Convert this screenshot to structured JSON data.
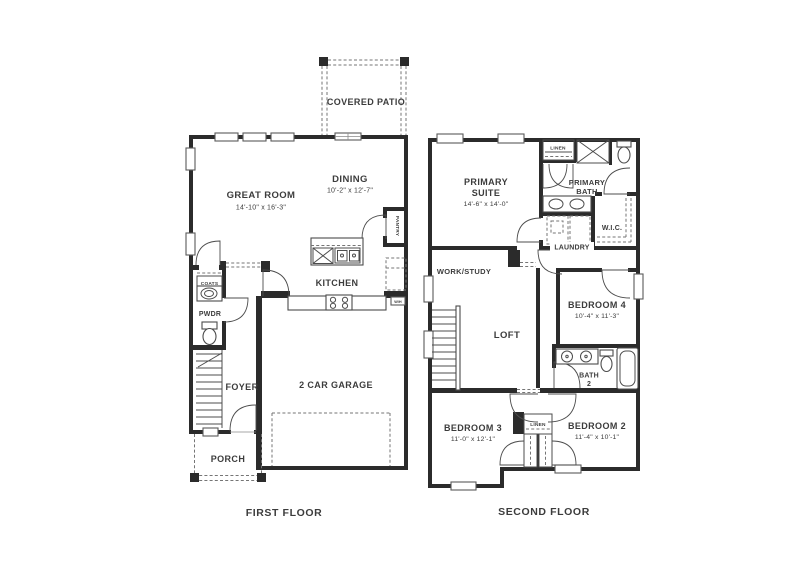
{
  "floors": {
    "first": {
      "title": "FIRST FLOOR",
      "covered_patio": "COVERED PATIO",
      "great_room": {
        "label": "GREAT ROOM",
        "dims": "14'-10\" x 16'-3\""
      },
      "dining": {
        "label": "DINING",
        "dims": "10'-2\" x 12'-7\""
      },
      "kitchen": "KITCHEN",
      "pantry": "PANTRY",
      "coats": "COATS",
      "powder": "PWDR",
      "foyer": "FOYER",
      "garage": "2 CAR GARAGE",
      "porch": "PORCH",
      "water_heater": "W/H"
    },
    "second": {
      "title": "SECOND FLOOR",
      "primary_suite": {
        "line1": "PRIMARY",
        "line2": "SUITE",
        "dims": "14'-6\" x 14'-0\""
      },
      "linen_upper": "LINEN",
      "primary_bath": {
        "line1": "PRIMARY",
        "line2": "BATH"
      },
      "wic": "W.I.C.",
      "laundry": "LAUNDRY",
      "work_study": "WORK/STUDY",
      "loft": "LOFT",
      "bedroom4": {
        "label": "BEDROOM 4",
        "dims": "10'-4\" x 11'-3\""
      },
      "bath2": {
        "line1": "BATH",
        "line2": "2"
      },
      "bedroom3": {
        "label": "BEDROOM 3",
        "dims": "11'-0\" x 12'-1\""
      },
      "linen_lower": "LINEN",
      "bedroom2": {
        "label": "BEDROOM 2",
        "dims": "11'-4\" x 10'-1\""
      }
    }
  },
  "colors": {
    "wall": "#2b2b2b",
    "line": "#4c4c4c",
    "dash": "#757575",
    "text": "#3c3c3c",
    "background": "#ffffff"
  }
}
